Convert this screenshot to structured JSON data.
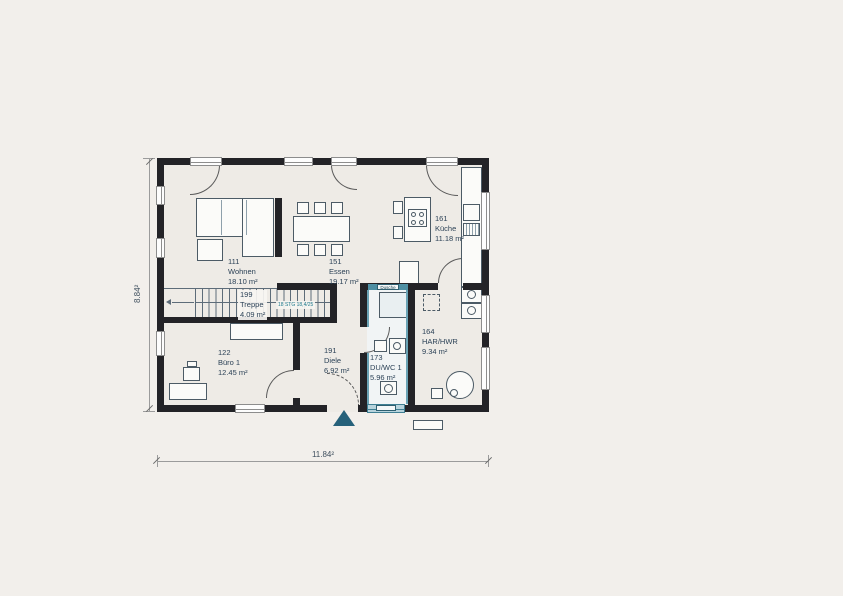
{
  "plan": {
    "rooms": {
      "wohnen": {
        "number": "111",
        "name": "Wohnen",
        "area": "18.10 m²"
      },
      "essen": {
        "number": "151",
        "name": "Essen",
        "area": "19.17 m²"
      },
      "kueche": {
        "number": "161",
        "name": "Küche",
        "area": "11.18 m²"
      },
      "treppe": {
        "number": "199",
        "name": "Treppe",
        "area": "4.09 m²"
      },
      "buero": {
        "number": "122",
        "name": "Büro 1",
        "area": "12.45 m²"
      },
      "diele": {
        "number": "191",
        "name": "Diele",
        "area": "6.92 m²"
      },
      "duwc": {
        "number": "173",
        "name": "DU/WC 1",
        "area": "5.96 m²"
      },
      "harhwr": {
        "number": "164",
        "name": "HAR/HWR",
        "area": "9.34 m²"
      }
    },
    "stairs": {
      "annotation": "18 STG 18,4/25"
    },
    "fixtures": {
      "shower_label": "Dusche"
    },
    "dimensions": {
      "overall_width": "11.84²",
      "overall_height": "8.84²"
    },
    "colors": {
      "background": "#f2efeb",
      "floor": "#eeebe6",
      "wall": "#232327",
      "teal_accent": "#4e8fa3",
      "entrance_marker": "#26617a",
      "furniture_stroke": "#4c5b66",
      "label_text": "#2c4257"
    }
  }
}
